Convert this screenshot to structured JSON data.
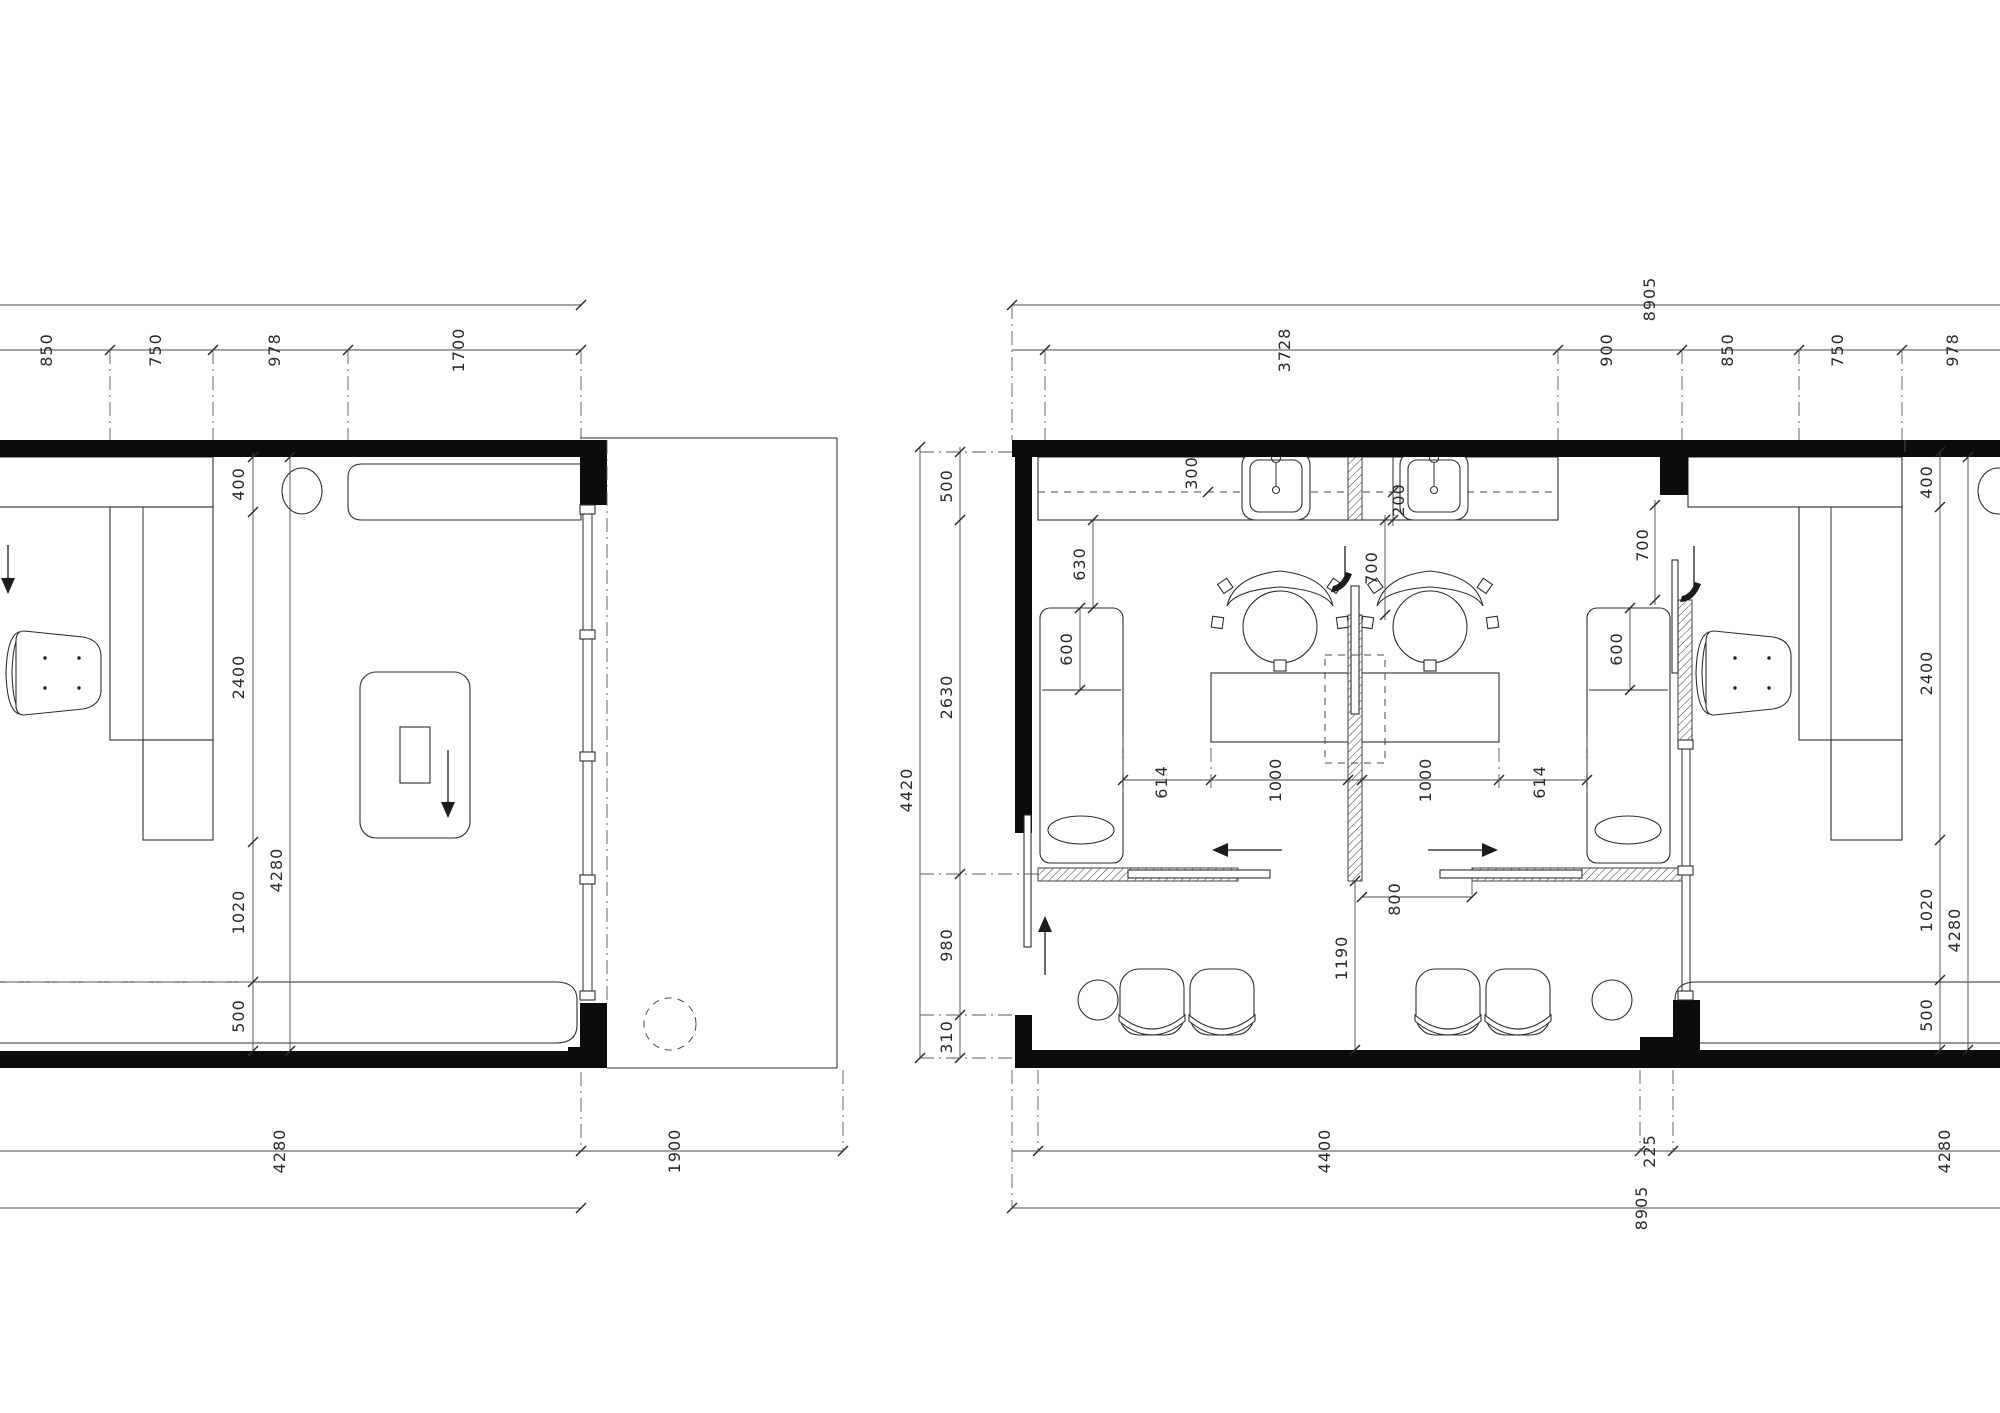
{
  "document": {
    "type": "architectural-floor-plan",
    "sheet_background": "#ffffff",
    "ink_color": "#1f1f1f",
    "units": "mm"
  },
  "plan_left": {
    "name": "room-plan-single-office",
    "furniture": [
      "corner-desk",
      "task-chair",
      "wall-counter",
      "stool",
      "rug-with-table",
      "bench",
      "glazed-window-wall",
      "dashed-column"
    ],
    "dim_labels": [
      {
        "t": "850",
        "x": 52,
        "y": 350
      },
      {
        "t": "750",
        "x": 161,
        "y": 350
      },
      {
        "t": "978",
        "x": 280,
        "y": 350
      },
      {
        "t": "1700",
        "x": 464,
        "y": 350
      },
      {
        "t": "400",
        "x": 244,
        "y": 484
      },
      {
        "t": "2400",
        "x": 244,
        "y": 677
      },
      {
        "t": "1020",
        "x": 244,
        "y": 912
      },
      {
        "t": "500",
        "x": 244,
        "y": 1016
      },
      {
        "t": "4280",
        "x": 282,
        "y": 870
      },
      {
        "t": "4280",
        "x": 285,
        "y": 1151
      },
      {
        "t": "1900",
        "x": 680,
        "y": 1151
      }
    ]
  },
  "plan_right": {
    "name": "room-plan-office-suite",
    "furniture": [
      "sink-counter",
      "sink",
      "sink",
      "privacy-screen",
      "meeting-table",
      "meeting-chair",
      "meeting-chair",
      "wardrobe-cabinet",
      "wardrobe-cabinet",
      "sliding-door",
      "sliding-door",
      "entry-door",
      "waiting-chair",
      "waiting-chair",
      "waiting-chair",
      "waiting-chair",
      "side-table",
      "side-table",
      "corner-desk",
      "task-chair",
      "stool",
      "bench",
      "glazed-window-wall"
    ],
    "dim_labels": [
      {
        "t": "8905",
        "x": 1655,
        "y": 299
      },
      {
        "t": "3728",
        "x": 1290,
        "y": 350
      },
      {
        "t": "900",
        "x": 1612,
        "y": 350
      },
      {
        "t": "850",
        "x": 1733,
        "y": 350
      },
      {
        "t": "750",
        "x": 1843,
        "y": 350
      },
      {
        "t": "978",
        "x": 1958,
        "y": 350
      },
      {
        "t": "4420",
        "x": 912,
        "y": 790
      },
      {
        "t": "500",
        "x": 952,
        "y": 486
      },
      {
        "t": "2630",
        "x": 952,
        "y": 697
      },
      {
        "t": "980",
        "x": 952,
        "y": 945
      },
      {
        "t": "310",
        "x": 952,
        "y": 1037
      },
      {
        "t": "300",
        "x": 1197,
        "y": 473
      },
      {
        "t": "200",
        "x": 1404,
        "y": 500
      },
      {
        "t": "630",
        "x": 1085,
        "y": 564
      },
      {
        "t": "600",
        "x": 1072,
        "y": 649
      },
      {
        "t": "700",
        "x": 1377,
        "y": 568
      },
      {
        "t": "614",
        "x": 1167,
        "y": 782
      },
      {
        "t": "1000",
        "x": 1281,
        "y": 780
      },
      {
        "t": "1000",
        "x": 1431,
        "y": 780
      },
      {
        "t": "614",
        "x": 1545,
        "y": 782
      },
      {
        "t": "800",
        "x": 1400,
        "y": 899
      },
      {
        "t": "1190",
        "x": 1347,
        "y": 958
      },
      {
        "t": "700",
        "x": 1648,
        "y": 545
      },
      {
        "t": "600",
        "x": 1622,
        "y": 649
      },
      {
        "t": "400",
        "x": 1932,
        "y": 482
      },
      {
        "t": "2400",
        "x": 1932,
        "y": 673
      },
      {
        "t": "1020",
        "x": 1932,
        "y": 910
      },
      {
        "t": "500",
        "x": 1932,
        "y": 1015
      },
      {
        "t": "4280",
        "x": 1960,
        "y": 930
      },
      {
        "t": "4400",
        "x": 1330,
        "y": 1151
      },
      {
        "t": "225",
        "x": 1655,
        "y": 1151
      },
      {
        "t": "4280",
        "x": 1950,
        "y": 1151
      },
      {
        "t": "8905",
        "x": 1647,
        "y": 1208
      }
    ]
  }
}
